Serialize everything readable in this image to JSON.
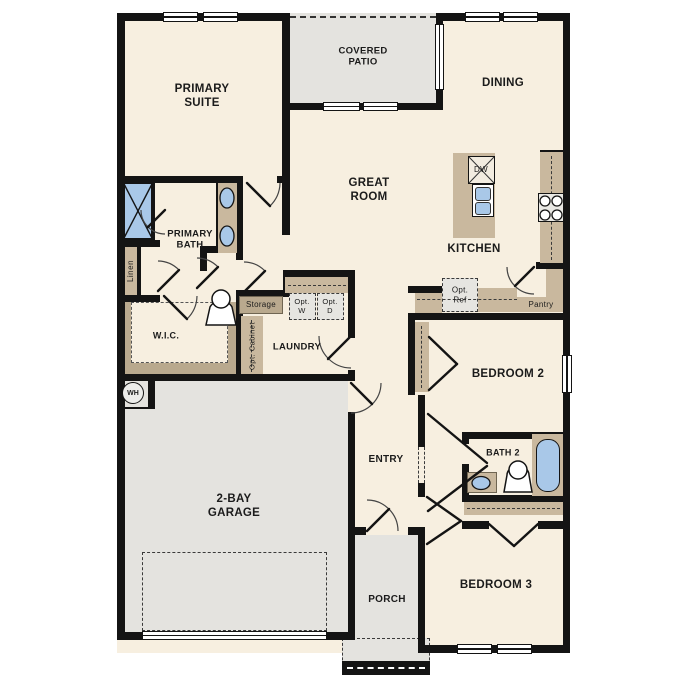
{
  "plan_title": "single-story floor plan",
  "colors": {
    "floor_cream": "#f7efe0",
    "concrete_gray": "#e4e3df",
    "cabinet_tan": "#c9b89e",
    "shelf_tan": "#b9a98e",
    "fixture_blue": "#a9c8e8",
    "wall_black": "#141414",
    "text": "#1b1b1b"
  },
  "rooms": {
    "primary_suite": "PRIMARY SUITE",
    "covered_patio": "COVERED PATIO",
    "dining": "DINING",
    "great_room": "GREAT ROOM",
    "kitchen": "KITCHEN",
    "primary_bath": "PRIMARY BATH",
    "wic": "W.I.C.",
    "laundry": "LAUNDRY",
    "entry": "ENTRY",
    "bedroom2": "BEDROOM 2",
    "bath2": "BATH 2",
    "bedroom3": "BEDROOM 3",
    "garage": "2-BAY GARAGE",
    "porch": "PORCH"
  },
  "closets_and_fixtures": {
    "linen": "Linen",
    "storage": "Storage",
    "opt_cabinet": "Opt. Cabinet",
    "opt_washer": "Opt. W",
    "opt_dryer": "Opt. D",
    "opt_refrigerator": "Opt. Ref",
    "pantry": "Pantry",
    "dishwasher": "DW",
    "water_heater": "WH"
  }
}
